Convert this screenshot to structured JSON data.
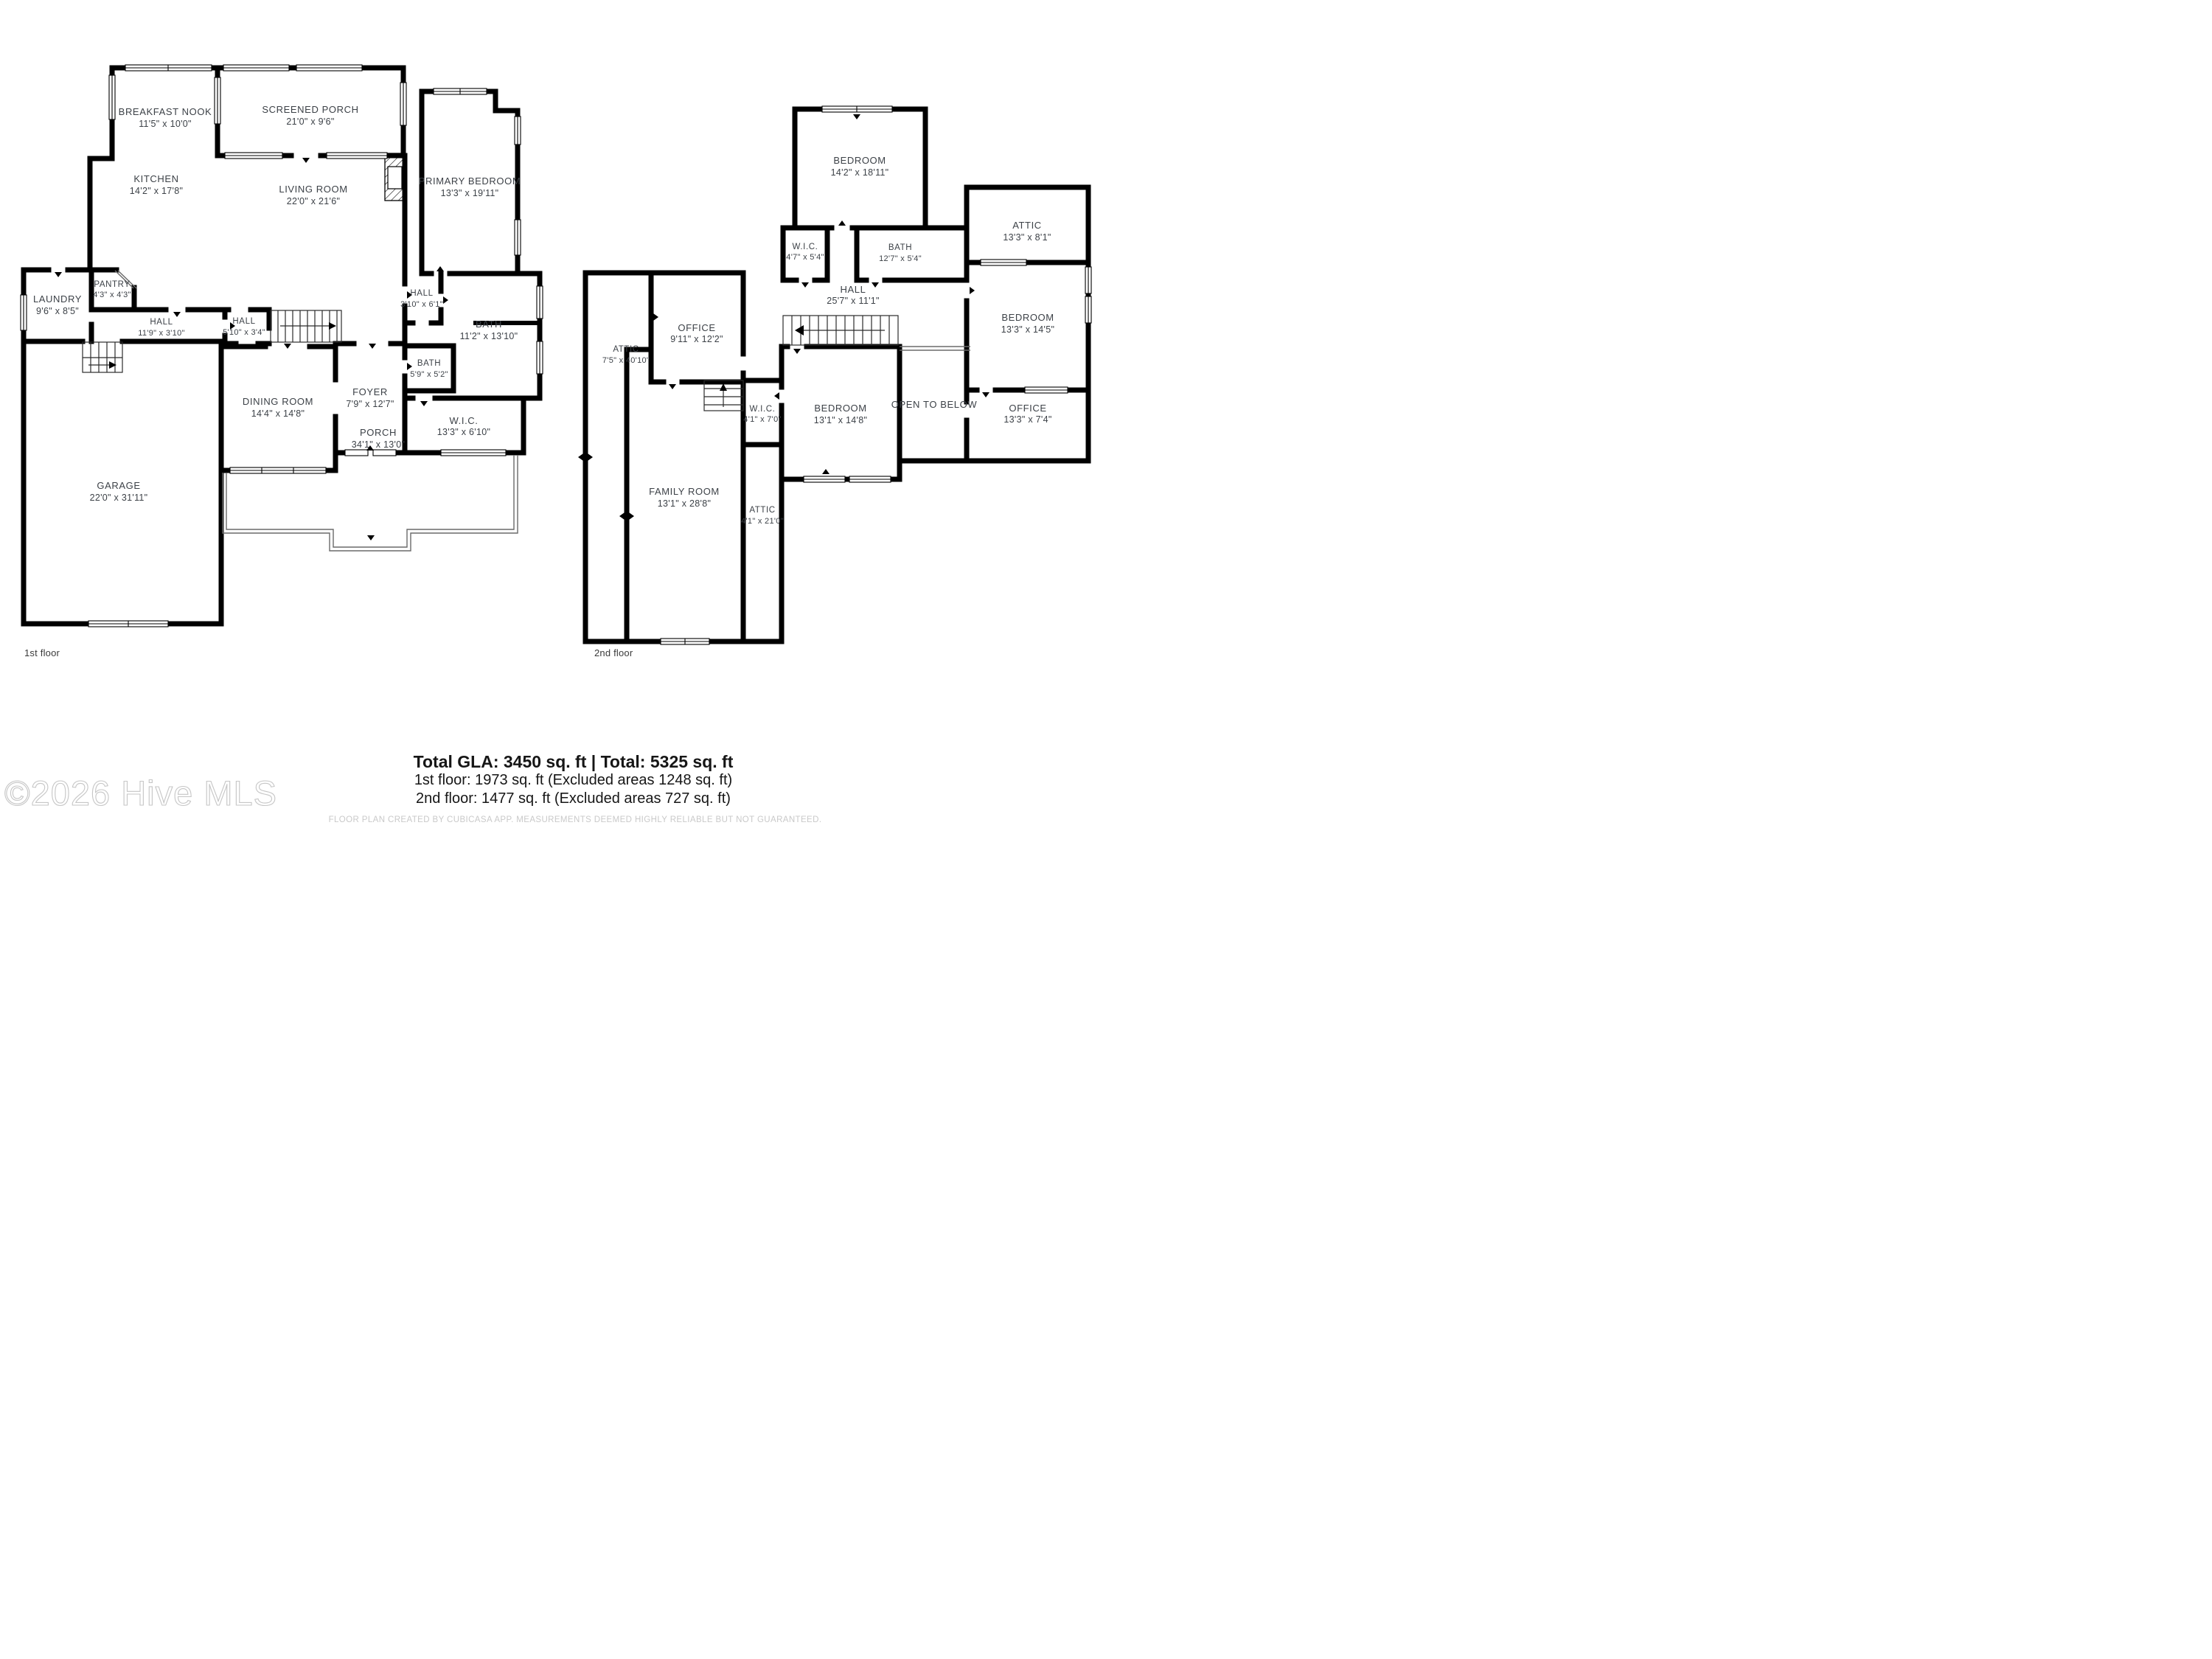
{
  "floors": [
    {
      "label": "1st floor",
      "rooms": [
        {
          "name": "BREAKFAST NOOK",
          "dims": "11'5\" x 10'0\""
        },
        {
          "name": "SCREENED PORCH",
          "dims": "21'0\" x 9'6\""
        },
        {
          "name": "PRIMARY BEDROOM",
          "dims": "13'3\" x 19'11\""
        },
        {
          "name": "KITCHEN",
          "dims": "14'2\" x 17'8\""
        },
        {
          "name": "LIVING ROOM",
          "dims": "22'0\" x 21'6\""
        },
        {
          "name": "LAUNDRY",
          "dims": "9'6\" x 8'5\""
        },
        {
          "name": "PANTRY",
          "dims": "4'3\" x 4'3\""
        },
        {
          "name": "HALL",
          "dims": "11'9\" x 3'10\""
        },
        {
          "name": "HALL",
          "dims": "5'10\" x 3'4\""
        },
        {
          "name": "HALL",
          "dims": "3'10\" x 6'1\""
        },
        {
          "name": "BATH",
          "dims": "11'2\" x 13'10\""
        },
        {
          "name": "BATH",
          "dims": "5'9\" x 5'2\""
        },
        {
          "name": "FOYER",
          "dims": "7'9\" x 12'7\""
        },
        {
          "name": "W.I.C.",
          "dims": "13'3\" x 6'10\""
        },
        {
          "name": "DINING ROOM",
          "dims": "14'4\" x 14'8\""
        },
        {
          "name": "GARAGE",
          "dims": "22'0\" x 31'11\""
        },
        {
          "name": "PORCH",
          "dims": "34'1\" x 13'0\""
        }
      ]
    },
    {
      "label": "2nd floor",
      "rooms": [
        {
          "name": "BEDROOM",
          "dims": "14'2\" x 18'11\""
        },
        {
          "name": "ATTIC",
          "dims": "13'3\" x 8'1\""
        },
        {
          "name": "W.I.C.",
          "dims": "4'7\" x 5'4\""
        },
        {
          "name": "BATH",
          "dims": "12'7\" x 5'4\""
        },
        {
          "name": "HALL",
          "dims": "25'7\" x 11'1\""
        },
        {
          "name": "OFFICE",
          "dims": "9'11\" x 12'2\""
        },
        {
          "name": "ATTIC",
          "dims": "7'5\" x 40'10\""
        },
        {
          "name": "BEDROOM",
          "dims": "13'3\" x 14'5\""
        },
        {
          "name": "W.I.C.",
          "dims": "4'1\" x 7'0\""
        },
        {
          "name": "BEDROOM",
          "dims": "13'1\" x 14'8\""
        },
        {
          "name": "OPEN TO BELOW",
          "dims": ""
        },
        {
          "name": "OFFICE",
          "dims": "13'3\" x 7'4\""
        },
        {
          "name": "FAMILY ROOM",
          "dims": "13'1\" x 28'8\""
        },
        {
          "name": "ATTIC",
          "dims": "4'1\" x 21'0\""
        }
      ]
    }
  ],
  "footer": {
    "total_line": "Total GLA: 3450 sq. ft | Total: 5325 sq. ft",
    "floor1_line": "1st floor: 1973 sq. ft (Excluded areas 1248 sq. ft)",
    "floor2_line": "2nd floor: 1477 sq. ft (Excluded areas 727 sq. ft)",
    "disclaimer": "FLOOR PLAN CREATED BY CUBICASA APP. MEASUREMENTS DEEMED HIGHLY RELIABLE BUT NOT GUARANTEED."
  },
  "watermark": "©2026 Hive MLS",
  "colors": {
    "wall": "#000000",
    "label_text": "#3c4147",
    "footer_text": "#161616",
    "muted_text": "#c9c9c9",
    "watermark": "#c6c6c6",
    "background": "#ffffff"
  }
}
